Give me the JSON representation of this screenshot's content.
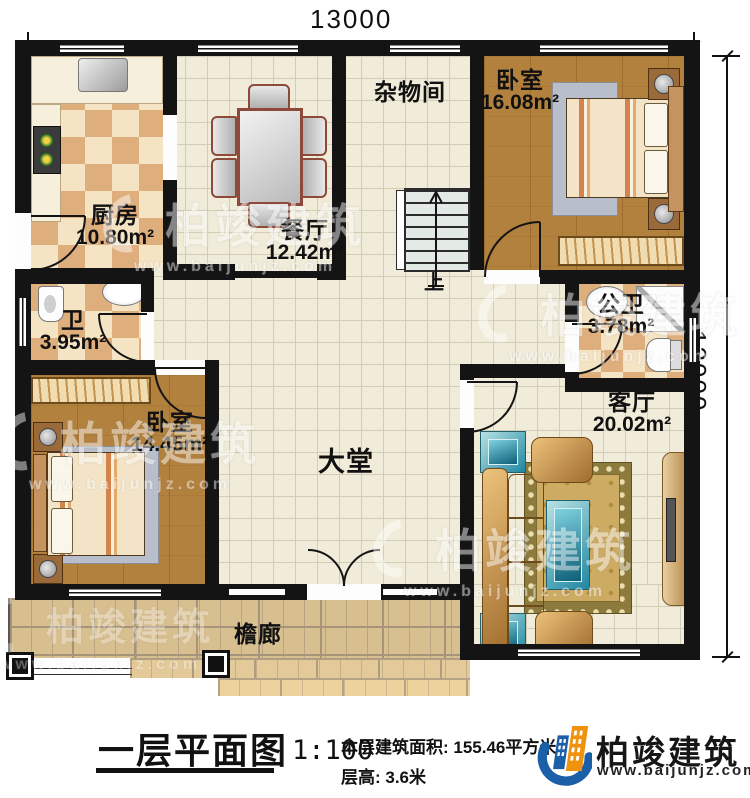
{
  "plan": {
    "dim_top": "13000",
    "dim_right": "12000",
    "rooms": {
      "kitchen": {
        "name": "厨房",
        "area": "10.80m²"
      },
      "dining": {
        "name": "餐厅",
        "area": "12.42m²"
      },
      "storage": {
        "name": "杂物间",
        "area": ""
      },
      "bedroom1": {
        "name": "卧室",
        "area": "16.08m²"
      },
      "bath1": {
        "name": "卫",
        "area": "3.95m²"
      },
      "bath2": {
        "name": "公卫",
        "area": "3.78m²"
      },
      "bedroom2": {
        "name": "卧室",
        "area": "14.45m²"
      },
      "hall": {
        "name": "大堂",
        "area": ""
      },
      "living": {
        "name": "客厅",
        "area": "20.02m²"
      },
      "porch": {
        "name": "檐廊",
        "area": ""
      }
    },
    "stairs_up": "上"
  },
  "footer": {
    "title": "一层平面图",
    "scale": "1:100",
    "area_label": "本层建筑面积: 155.46平方米",
    "floor_height": "层高: 3.6米"
  },
  "brand": {
    "name": "柏竣建筑",
    "url": "www.baijunjz.com"
  },
  "watermark": {
    "name": "柏竣建筑",
    "url": "www.baijunjz.com"
  }
}
